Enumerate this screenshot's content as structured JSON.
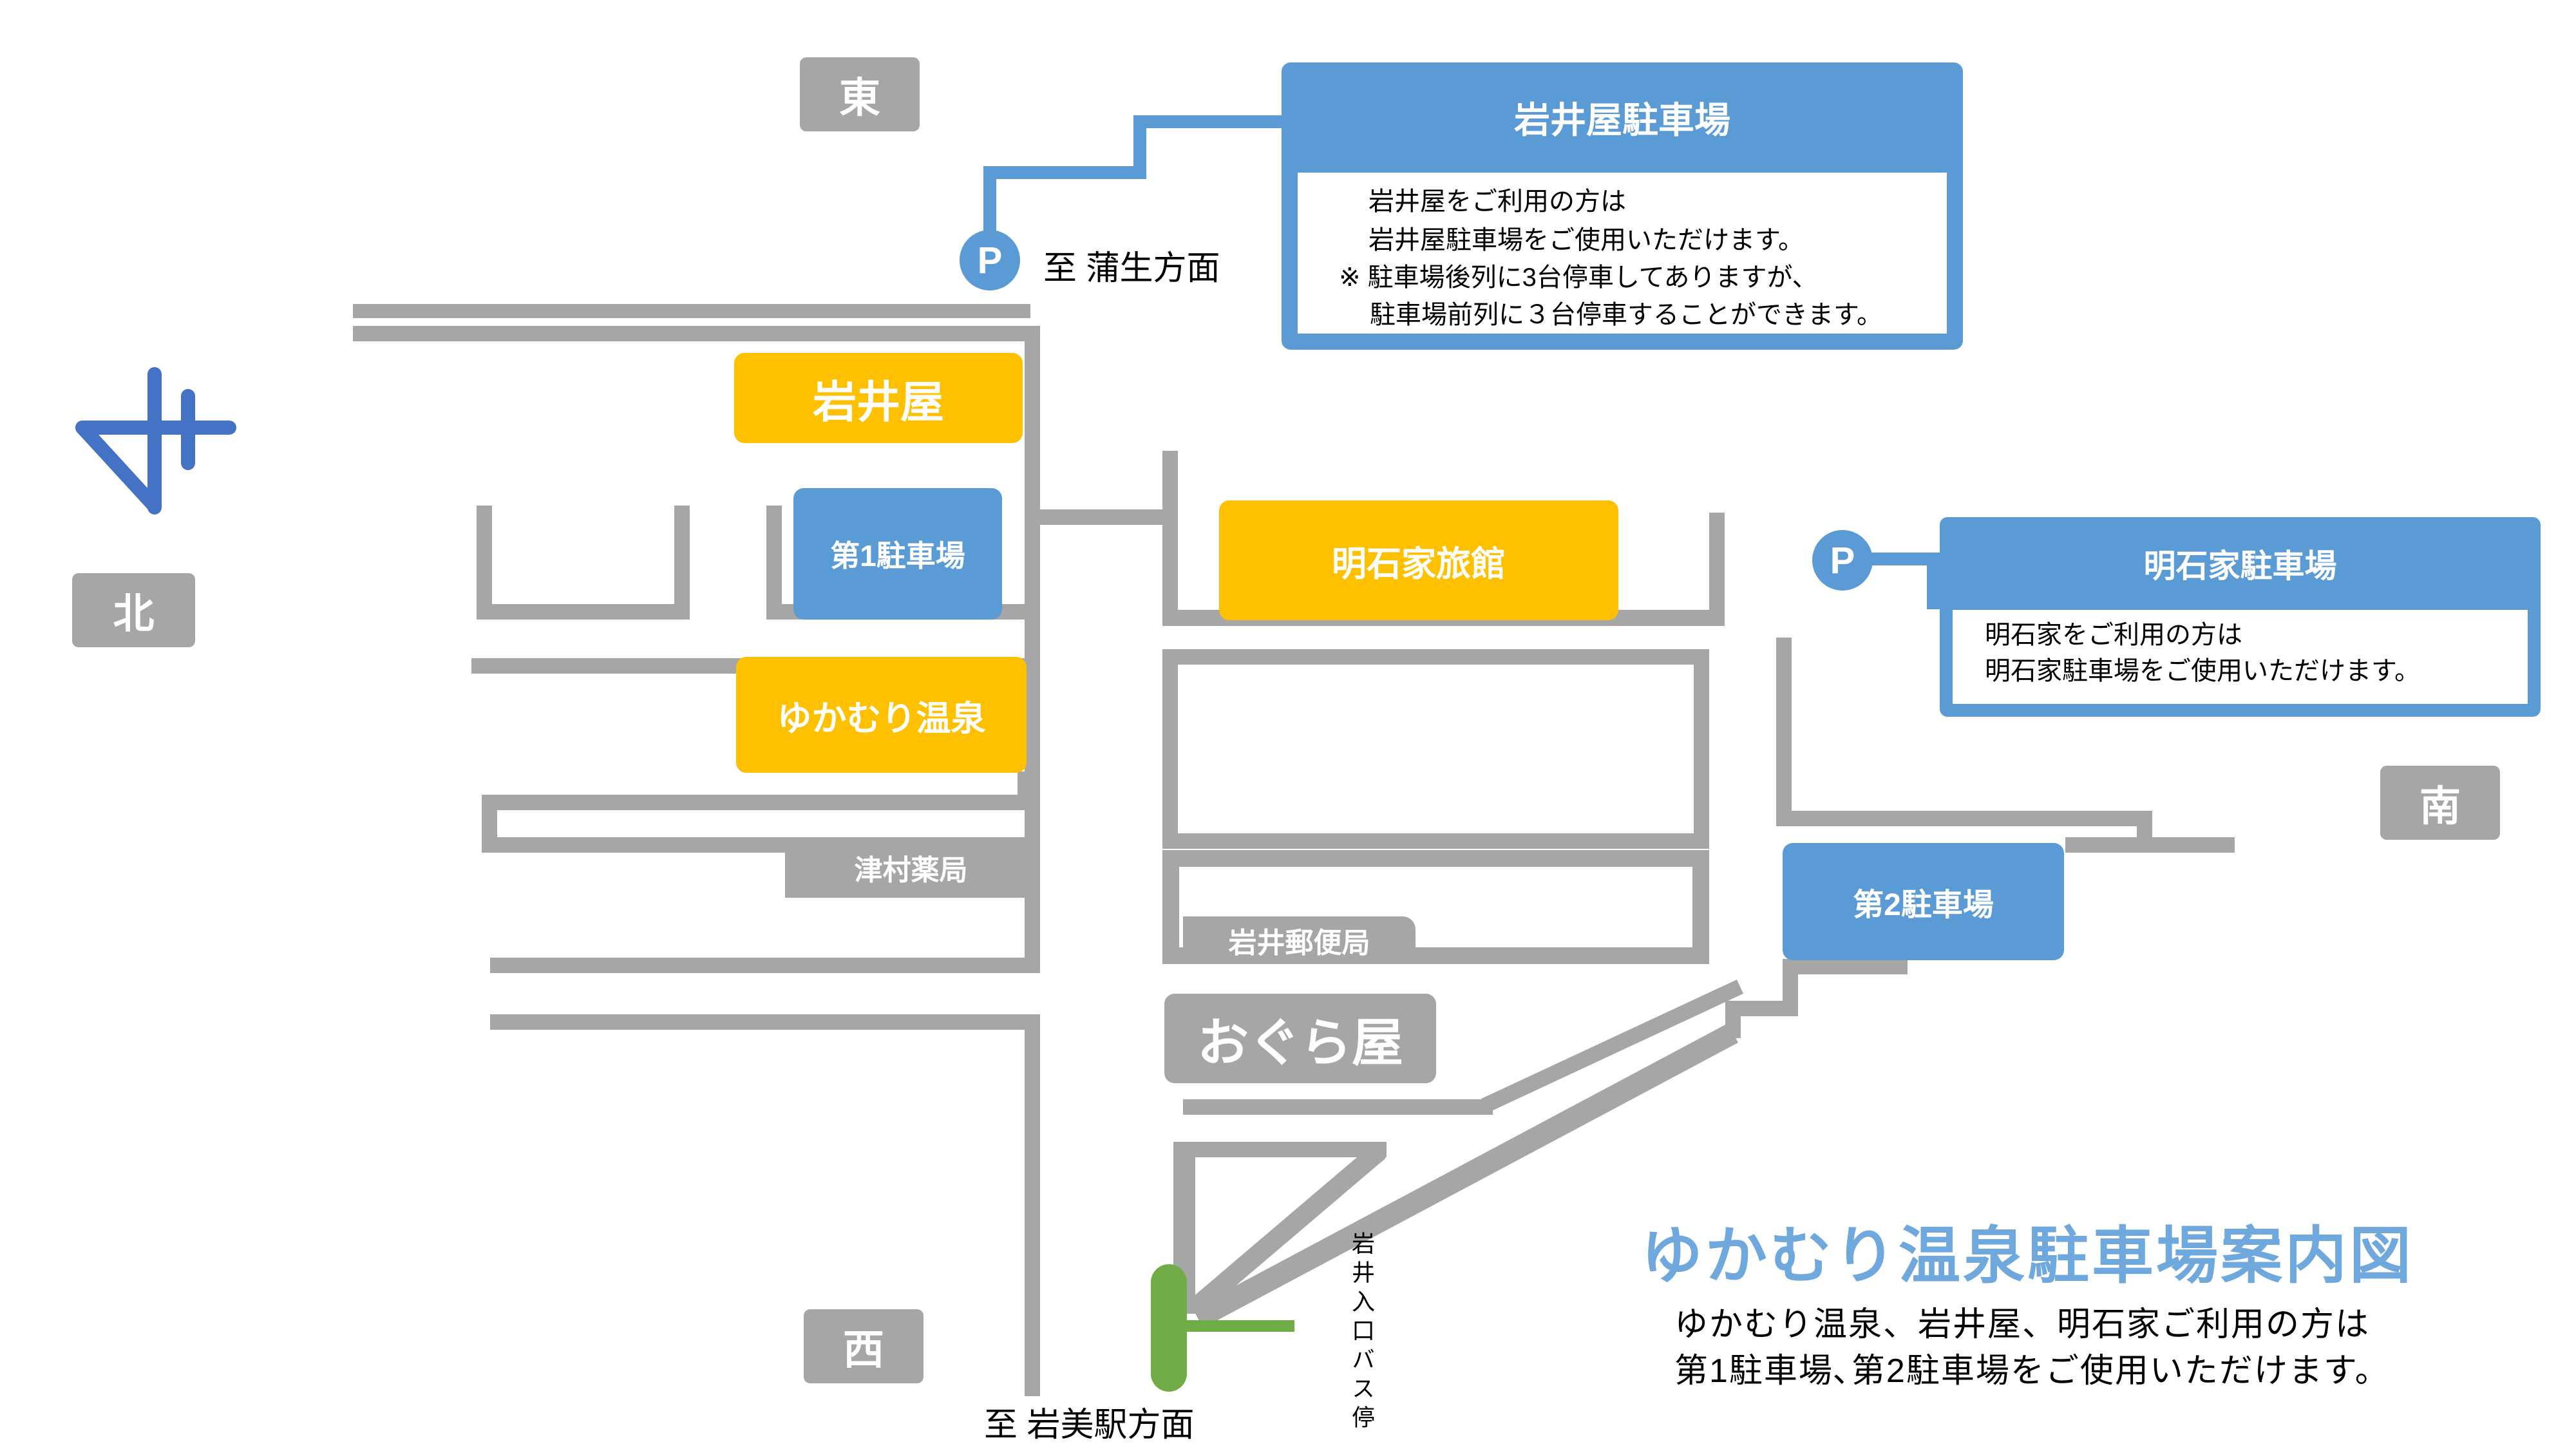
{
  "colors": {
    "road_gray": "#a6a6a6",
    "accent_blue": "#5b9bd5",
    "accent_yellow": "#ffc000",
    "bus_green": "#70ad47",
    "compass_blue": "#4472c4",
    "title_blue": "#6fa8dc"
  },
  "title": {
    "heading": "ゆかむり温泉駐車場案内図",
    "subtitle_line1": "ゆかむり温泉、岩井屋、明石家ご利用の方は",
    "subtitle_line2": "第1駐車場､第2駐車場をご使用いただけます。"
  },
  "directions": {
    "east": "東",
    "west": "西",
    "south": "南",
    "north": "北"
  },
  "places": {
    "iwaiya": "岩井屋",
    "parking1": "第1駐車場",
    "yukamuri_onsen": "ゆかむり温泉",
    "akashiya_ryokan": "明石家旅館",
    "parking2": "第2駐車場",
    "tsumura_pharmacy": "津村薬局",
    "iwai_post_office": "岩井郵便局",
    "oguraya": "おぐら屋"
  },
  "callouts": {
    "iwaiya_parking": {
      "p_mark": "P",
      "title": "岩井屋駐車場",
      "body_line1": "岩井屋をご利用の方は",
      "body_line2": "岩井屋駐車場をご使用いただけます。",
      "note_line1": "※ 駐車場後列に3台停車してありますが、",
      "note_line2": "駐車場前列に３台停車することができます。"
    },
    "akashiya_parking": {
      "p_mark": "P",
      "title": "明石家駐車場",
      "body_line1": "明石家をご利用の方は",
      "body_line2": "明石家駐車場をご使用いただけます。"
    }
  },
  "annotations": {
    "to_gamou": "至 蒲生方面",
    "to_iwami_station": "至 岩美駅方面",
    "bus_stop": "岩井入口バス停"
  }
}
